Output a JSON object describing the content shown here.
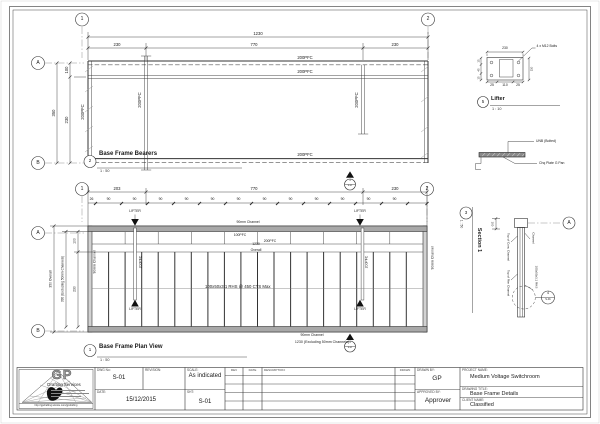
{
  "view_bubbles": {
    "v1": "1",
    "v2": "2",
    "ga": "A",
    "gb": "B"
  },
  "top_view": {
    "num": "2",
    "title": "Base Frame Bearers",
    "scale": "1 : 50",
    "dim_overall": "1230",
    "seg1": "230",
    "seg2": "770",
    "seg3": "230",
    "left_outer": "350",
    "left_top": "100",
    "left_mid": "230",
    "pfc": "200PFC"
  },
  "plan_view": {
    "num": "1",
    "title": "Base Frame Plan View",
    "scale": "1 : 50",
    "seg1": "203",
    "seg2": "770",
    "seg3": "230",
    "first": "26",
    "stud": "90",
    "lifter": "LIFTER",
    "ch90": "90mm Channel",
    "pfc100": "100PFC",
    "pfc200": "200PFC",
    "mid1": "1230",
    "mid2": "Overall",
    "rhs": "100x50x3.1 RHS @ 450 CTS Max",
    "bottom": "1230 (Excluding 50mm Channels)",
    "left_outer": "350 Overall",
    "left_excl": "330 (Excluding 50mm Channels)",
    "left_top": "100",
    "left_mid": "230",
    "sec_num": "3",
    "sec_sheet": "S-01"
  },
  "lifter": {
    "num": "5",
    "title": "Lifter",
    "scale": "1 : 10",
    "note": "4 x M12 Bolts",
    "top": "230",
    "b1": "25",
    "b2": "110",
    "b3": "25",
    "l1": "15",
    "l2": "45",
    "l3": "15",
    "r1": "110"
  },
  "bracket": {
    "l1": "UNB (Bolted)",
    "l2": "Chq Plate G Pan"
  },
  "section": {
    "num": "3",
    "title": "Section 1",
    "scale": "1 : 50",
    "ga": "A",
    "det_num": "4",
    "det_sheet": "S-01",
    "conc": "Top of Conc Channel",
    "chan": "Channel",
    "rim": "Top of Rim Channel",
    "rhs": "100x50x3.1 RHS",
    "dim": "100"
  },
  "title_block": {
    "gp": "GP",
    "name": "Drafting Services",
    "url": "http://gpdrafting.wixsite.com/gpdrafting",
    "dwg_label": "DWG No:",
    "dwg": "S-01",
    "rev_label": "REVISION:",
    "scale_label": "SCALE:",
    "scale": "As indicated",
    "date_label": "DATE:",
    "date": "15/12/2015",
    "sht_label": "SHT:",
    "sht": "S-01",
    "col_rev": "REV",
    "col_date": "DATE",
    "col_desc": "DESCRIPTION:",
    "col_drawn": "DRAWN",
    "drawn_label": "DRAWN BY:",
    "drawn": "GP",
    "appr_label": "APPROVED BY:",
    "appr": "Approver",
    "proj_label": "PROJECT NAME:",
    "proj": "Medium Voltage Switchroom",
    "title_label": "DRAWING TITLE:",
    "title": "Base Frame Details",
    "client_label": "CLIENT NAME:",
    "client": "Classified"
  }
}
